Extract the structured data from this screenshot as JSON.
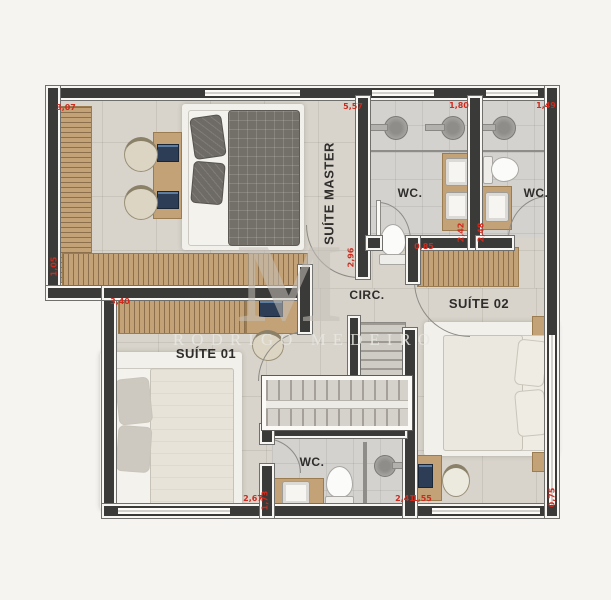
{
  "title": "floor-plan-upper-level",
  "watermark": {
    "monogram": "M",
    "name": "RODRIGO MEDEIRO"
  },
  "rooms": {
    "suite_master": {
      "label": "SUÍTE MASTER"
    },
    "wc_master": {
      "label": "WC."
    },
    "wc_suite02": {
      "label": "WC."
    },
    "circ": {
      "label": "CIRC."
    },
    "suite01": {
      "label": "SUÍTE 01"
    },
    "suite02": {
      "label": "SUÍTE 02"
    },
    "wc_suite01": {
      "label": "WC."
    }
  },
  "dimensions": [
    {
      "value": "3,07"
    },
    {
      "value": "5,57"
    },
    {
      "value": "1,80"
    },
    {
      "value": "1,49"
    },
    {
      "value": "1,05"
    },
    {
      "value": "2,96"
    },
    {
      "value": "2,42"
    },
    {
      "value": "2,48"
    },
    {
      "value": "0,85"
    },
    {
      "value": "3,40"
    },
    {
      "value": "2,67"
    },
    {
      "value": "1,73"
    },
    {
      "value": "2,41"
    },
    {
      "value": "1,55"
    },
    {
      "value": "0,75"
    }
  ],
  "colors": {
    "wall": "#3a3a39",
    "floor": "#d8d4cc",
    "wood": "#c3a278",
    "dimension_red": "#cf2a1d",
    "watermark_gray": "#c8c4bc"
  }
}
